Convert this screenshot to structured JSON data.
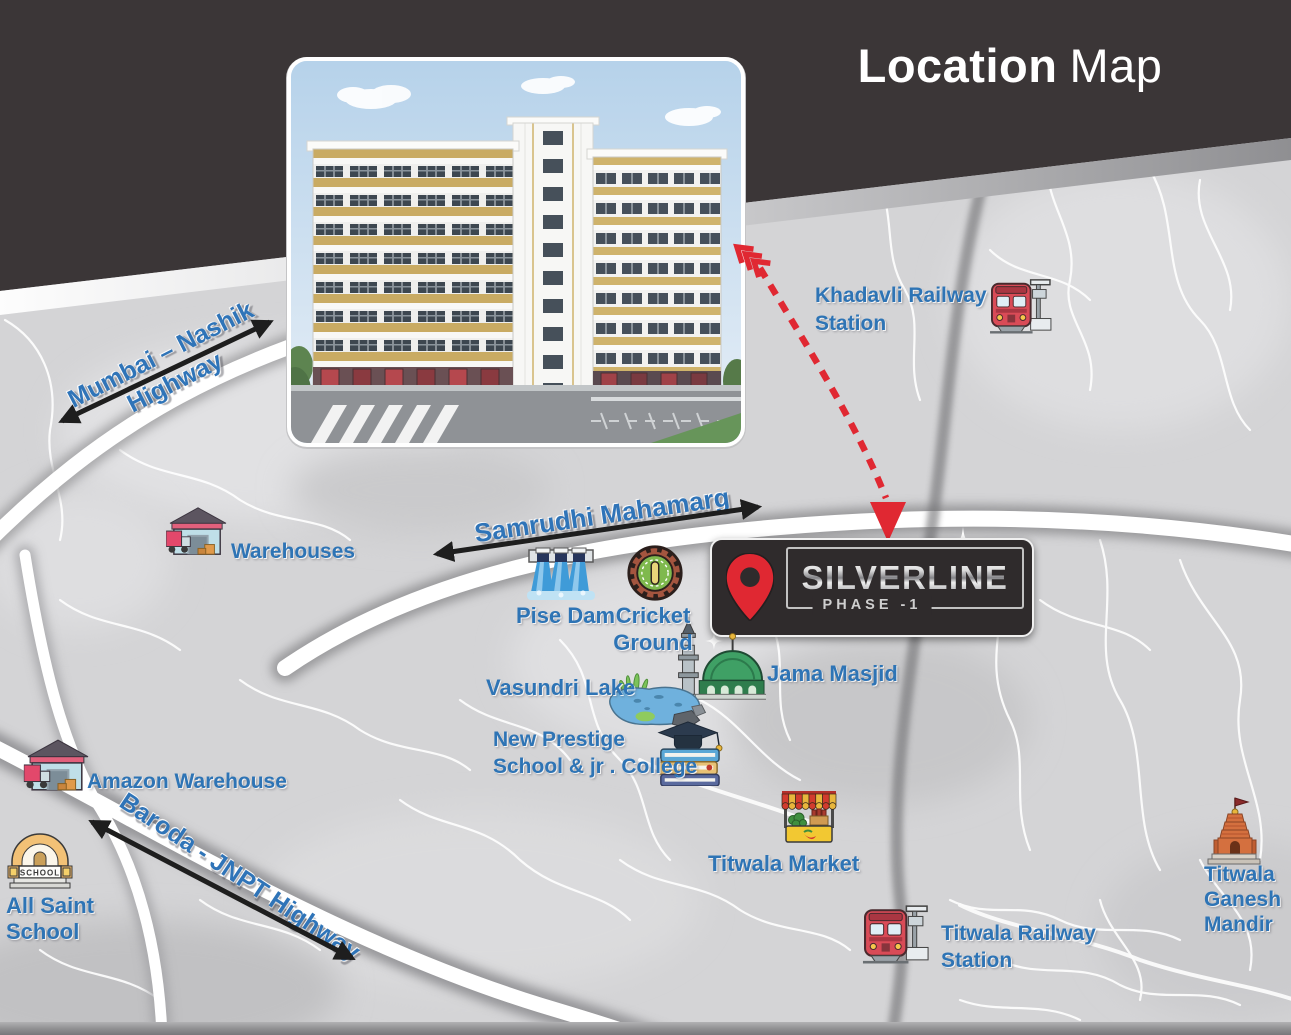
{
  "title": {
    "bold": "Location",
    "regular": "Map"
  },
  "sign": {
    "name": "SILVERLINE",
    "phase": "PHASE -1",
    "pin_icon": "location-pin-icon"
  },
  "highways": {
    "mumbai_nashik": {
      "line1": "Mumbai – Nashik",
      "line2": "Highway"
    },
    "samrudhi": {
      "label": "Samrudhi Mahamarg"
    },
    "baroda": {
      "label": "Baroda - JNPT Highway"
    }
  },
  "pois": {
    "khadavli_station": {
      "line1": "Khadavli Railway",
      "line2": "Station",
      "icon": "train-icon"
    },
    "warehouses": {
      "label": "Warehouses",
      "icon": "warehouse-icon"
    },
    "pise_dam": {
      "label": "Pise Dam",
      "icon": "dam-icon"
    },
    "cricket_ground": {
      "line1": "Cricket",
      "line2": "Ground",
      "icon": "cricket-ground-icon"
    },
    "jama_masjid": {
      "label": "Jama Masjid",
      "icon": "mosque-icon"
    },
    "vasundri_lake": {
      "label": "Vasundri Lake",
      "icon": "lake-icon"
    },
    "new_prestige": {
      "line1": "New Prestige",
      "line2": "School & jr . College",
      "icon": "books-graduation-icon"
    },
    "amazon_warehouse": {
      "label": "Amazon Warehouse",
      "icon": "warehouse-icon"
    },
    "all_saint_school": {
      "line1": "All Saint",
      "line2": "School",
      "icon": "school-icon",
      "icon_text": "SCHOOL"
    },
    "titwala_market": {
      "label": "Titwala Market",
      "icon": "market-stall-icon"
    },
    "titwala_station": {
      "line1": "Titwala Railway",
      "line2": "Station",
      "icon": "train-icon"
    },
    "titwala_mandir": {
      "line1": "Titwala",
      "line2": "Ganesh",
      "line3": "Mandir",
      "icon": "temple-icon"
    }
  },
  "colors": {
    "header_dark": "#3b3637",
    "label_blue": "#2e74b5",
    "accent_red": "#e02832",
    "map_background": "#d4d4d6",
    "road_white": "#ffffff"
  }
}
